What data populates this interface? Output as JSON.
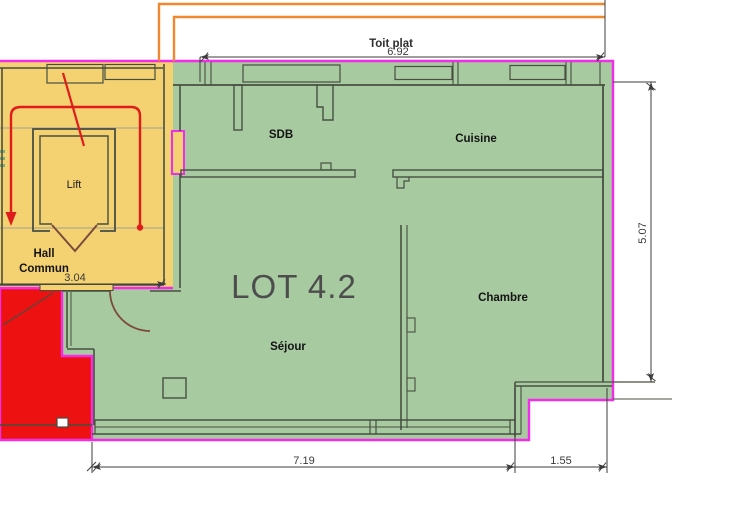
{
  "floor_plan": {
    "lot_title": "LOT 4.2",
    "roof_label": "Toit plat",
    "rooms": {
      "sdb": {
        "label": "SDB"
      },
      "cuisine": {
        "label": "Cuisine"
      },
      "chambre": {
        "label": "Chambre"
      },
      "sejour": {
        "label": "Séjour"
      },
      "lift": {
        "label": "Lift"
      },
      "hall": {
        "label_line1": "Hall",
        "label_line2": "Commun"
      }
    },
    "dimensions": {
      "roof_width": "6.92",
      "right_height": "5.07",
      "hall_width": "3.04",
      "bottom_width_main": "7.19",
      "bottom_width_right": "1.55"
    },
    "colors": {
      "apartment_fill": "#a7caa0",
      "hall_fill": "#f5d271",
      "red_zone_fill": "#ee1111",
      "lot_boundary": "#f22ce8",
      "roof_outline": "#f0882f",
      "walls": "#474f41",
      "dimension_lines": "#3c3c3c",
      "escape_route": "#e01b1b",
      "door_swing": "#7c4a3c",
      "lot_title_text": "#4d4d4d"
    }
  }
}
